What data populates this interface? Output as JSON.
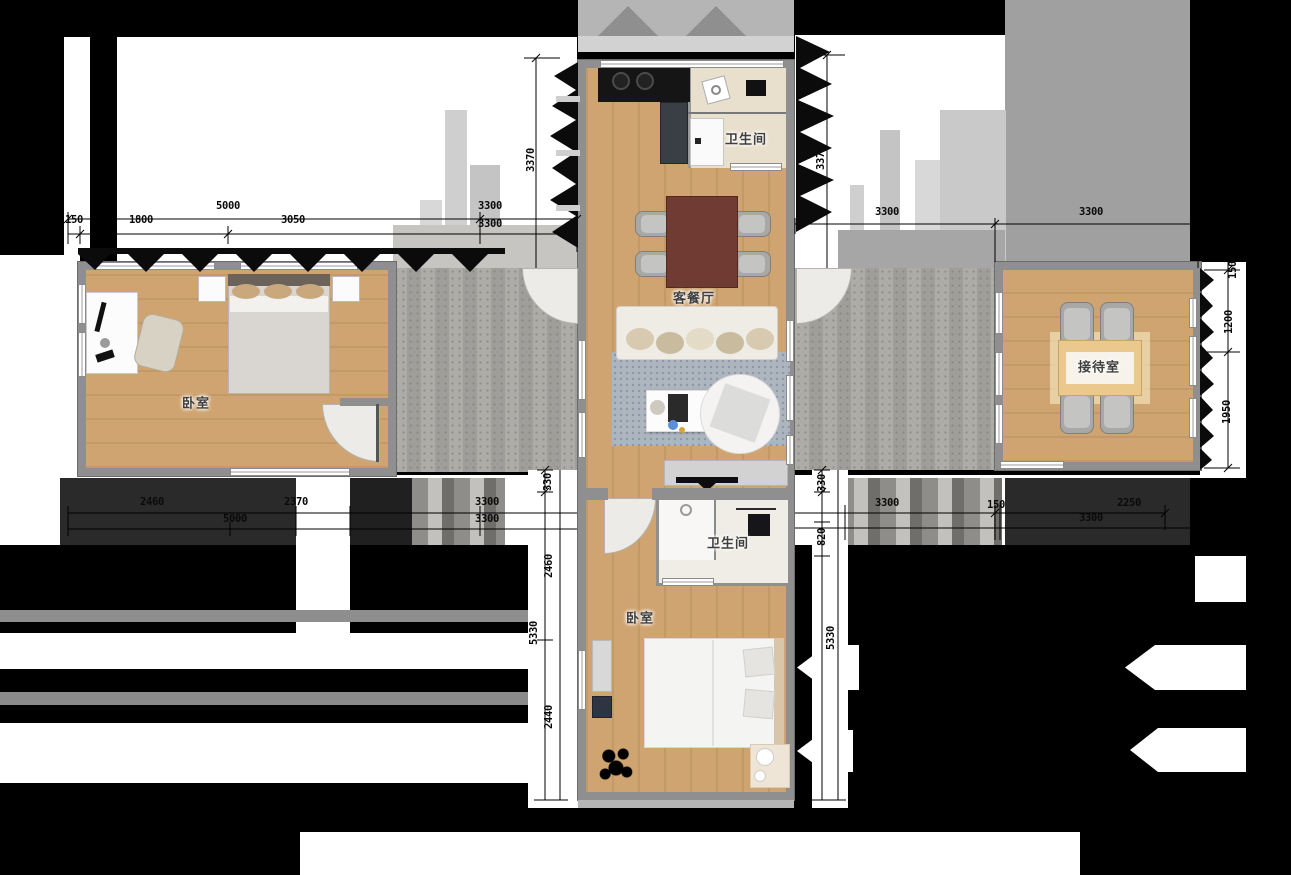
{
  "title": "apartment-floor-plan",
  "colors": {
    "floor": "#cfa470",
    "wall": "#8f8f8f",
    "corridor": "#a8a7a2",
    "corridorLight": "#c6c5c1",
    "roof": "#a0a0a0",
    "roofLight": "#c9c9c9",
    "counter": "#151515",
    "diningTable": "#6f3b33",
    "chair": "#a8a8a6",
    "rug": "#adb5bf",
    "sofa": "#efece6",
    "cushion": "#d3c4a6",
    "bed": "#f4f4f2",
    "blanket": "#d9d6d1",
    "receptionTable": "#ebc98c",
    "bathFloor": "#e9dfcd"
  },
  "rooms": [
    {
      "id": "bathroom-top",
      "label": "卫生间",
      "x": 746,
      "y": 138
    },
    {
      "id": "living-dining",
      "label": "客餐厅",
      "x": 694,
      "y": 297
    },
    {
      "id": "bedroom-left",
      "label": "卧室",
      "x": 196,
      "y": 402
    },
    {
      "id": "reception",
      "label": "接待室",
      "x": 1099,
      "y": 366
    },
    {
      "id": "bathroom-bottom",
      "label": "卫生间",
      "x": 728,
      "y": 542
    },
    {
      "id": "bedroom-bottom",
      "label": "卧室",
      "x": 640,
      "y": 617
    }
  ],
  "dimensions": [
    {
      "t": "5000",
      "x": 228,
      "y": 212
    },
    {
      "t": "3300",
      "x": 490,
      "y": 212
    },
    {
      "t": "150",
      "x": 74,
      "y": 226
    },
    {
      "t": "1800",
      "x": 141,
      "y": 226
    },
    {
      "t": "3050",
      "x": 293,
      "y": 226
    },
    {
      "t": "3300",
      "x": 490,
      "y": 230
    },
    {
      "t": "3300",
      "x": 887,
      "y": 218
    },
    {
      "t": "3300",
      "x": 1091,
      "y": 218
    },
    {
      "t": "3370",
      "x": 531,
      "y": 160,
      "v": true
    },
    {
      "t": "3370",
      "x": 821,
      "y": 158,
      "v": true
    },
    {
      "t": "150",
      "x": 1233,
      "y": 270,
      "v": true
    },
    {
      "t": "1200",
      "x": 1229,
      "y": 322,
      "v": true
    },
    {
      "t": "1950",
      "x": 1227,
      "y": 412,
      "v": true
    },
    {
      "t": "2460",
      "x": 152,
      "y": 508
    },
    {
      "t": "2370",
      "x": 296,
      "y": 508
    },
    {
      "t": "3300",
      "x": 487,
      "y": 508
    },
    {
      "t": "5000",
      "x": 235,
      "y": 525
    },
    {
      "t": "3300",
      "x": 487,
      "y": 525
    },
    {
      "t": "3300",
      "x": 887,
      "y": 509
    },
    {
      "t": "150",
      "x": 996,
      "y": 511
    },
    {
      "t": "2250",
      "x": 1129,
      "y": 509
    },
    {
      "t": "3300",
      "x": 1091,
      "y": 524
    },
    {
      "t": "330",
      "x": 548,
      "y": 482,
      "v": true
    },
    {
      "t": "2460",
      "x": 549,
      "y": 566,
      "v": true
    },
    {
      "t": "5330",
      "x": 534,
      "y": 633,
      "v": true
    },
    {
      "t": "2440",
      "x": 549,
      "y": 717,
      "v": true
    },
    {
      "t": "330",
      "x": 822,
      "y": 483,
      "v": true
    },
    {
      "t": "820",
      "x": 822,
      "y": 537,
      "v": true
    },
    {
      "t": "5330",
      "x": 831,
      "y": 638,
      "v": true
    }
  ]
}
